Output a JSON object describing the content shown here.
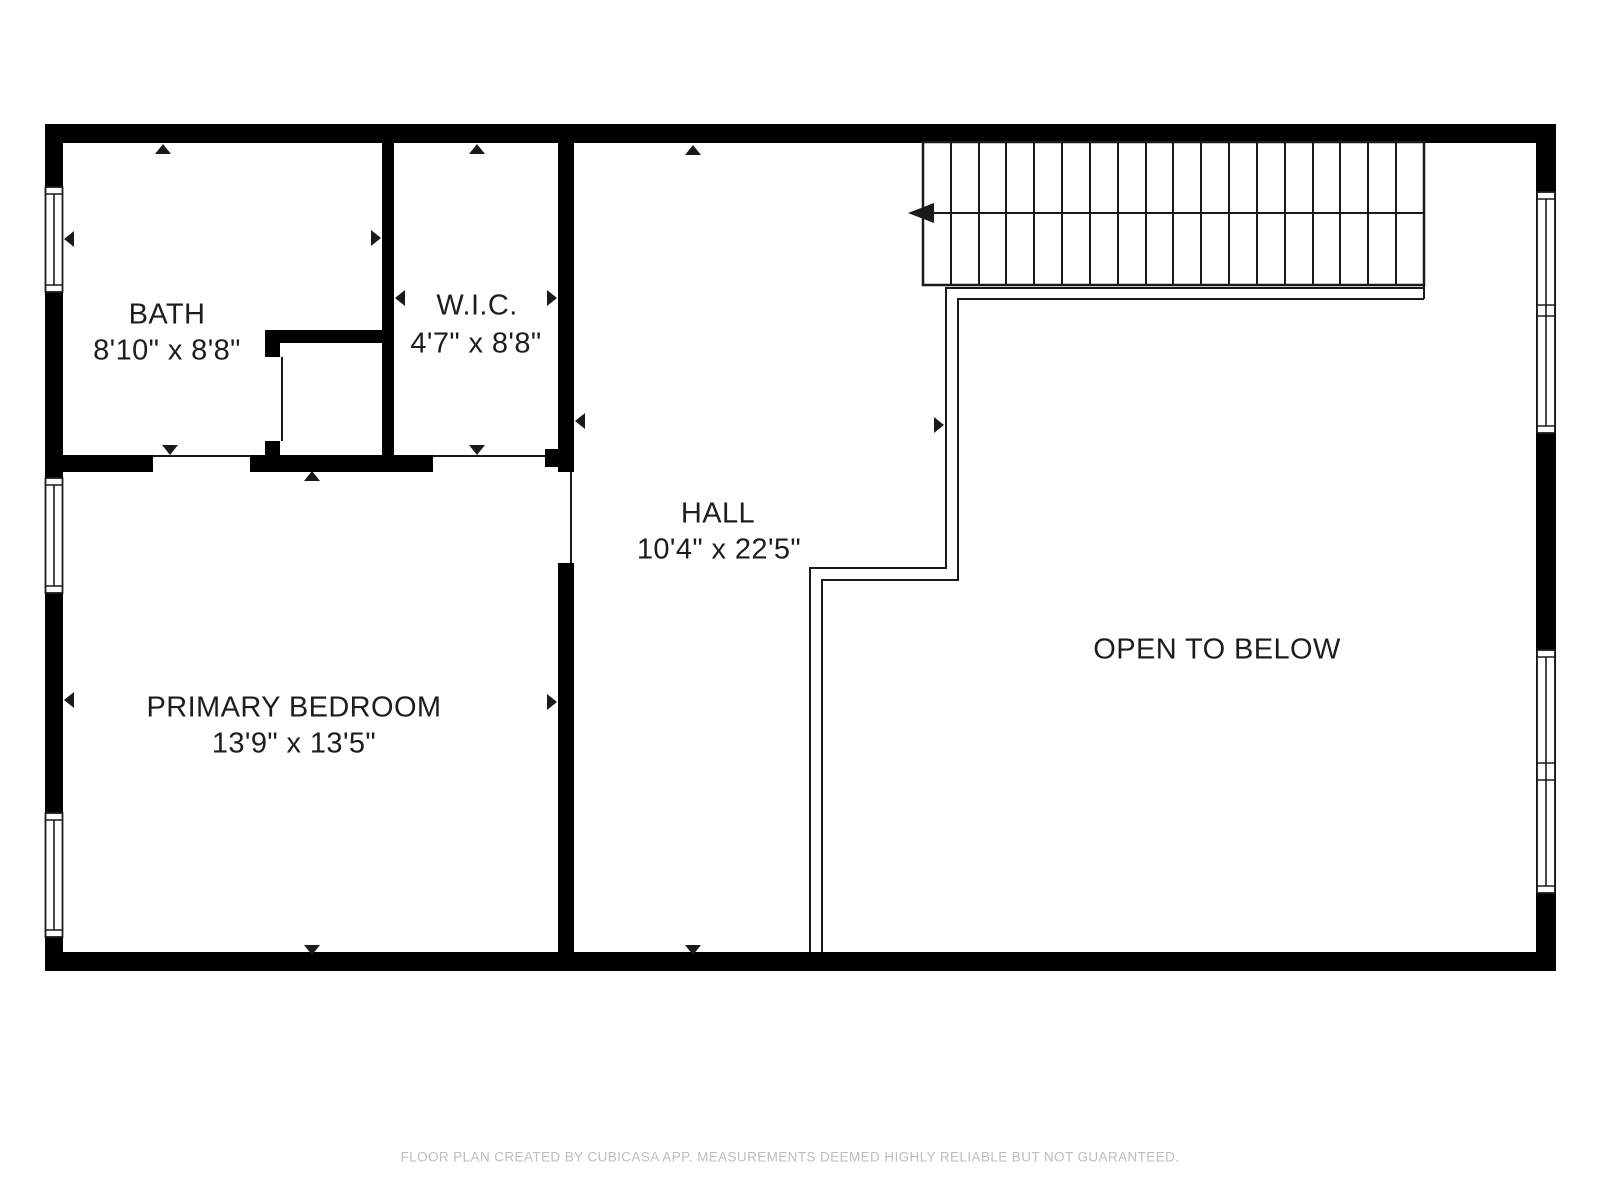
{
  "plan": {
    "rooms": {
      "bath": {
        "name": "BATH",
        "dims": "8'10\" x 8'8\""
      },
      "wic": {
        "name": "W.I.C.",
        "dims": "4'7\" x 8'8\""
      },
      "hall": {
        "name": "HALL",
        "dims": "10'4\" x 22'5\""
      },
      "primary_bedroom": {
        "name": "PRIMARY BEDROOM",
        "dims": "13'9\" x 13'5\""
      },
      "open_to_below": {
        "name": "OPEN TO BELOW"
      }
    },
    "stairs": {
      "tread_count": 18,
      "direction": "toward-hall-left"
    },
    "colors": {
      "wall": "#000000",
      "line": "#1a1a1a",
      "room_text": "#1d1d1d",
      "footer_text": "#bdbdbd",
      "background": "#ffffff"
    },
    "footer": "FLOOR PLAN CREATED BY CUBICASA APP. MEASUREMENTS DEEMED HIGHLY RELIABLE BUT NOT GUARANTEED."
  }
}
